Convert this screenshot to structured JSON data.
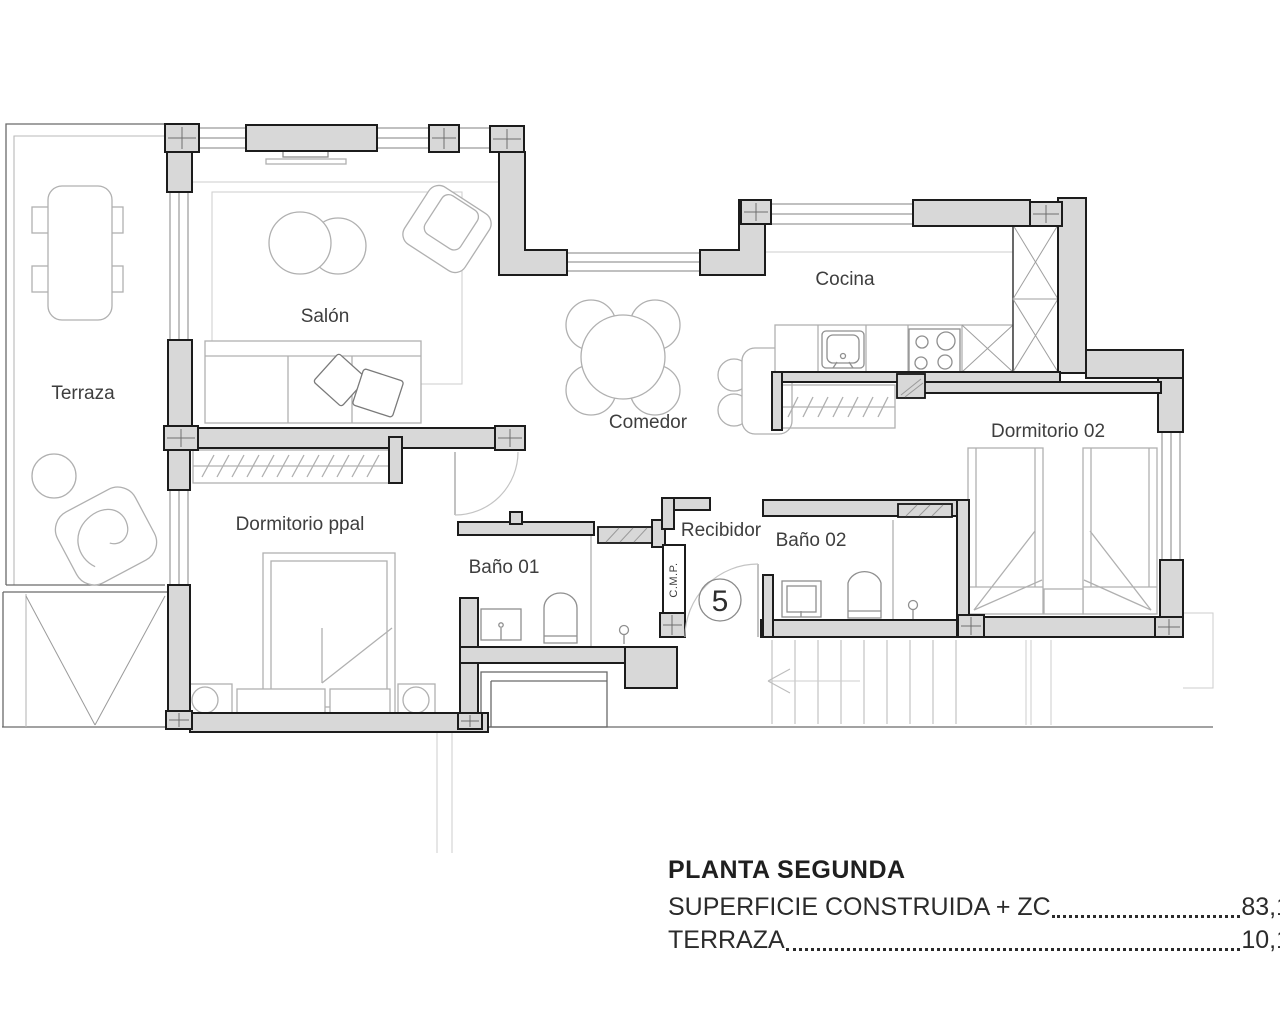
{
  "plan": {
    "rooms": {
      "terraza": "Terraza",
      "salon": "Salón",
      "cocina": "Cocina",
      "comedor": "Comedor",
      "dormitorio_ppal": "Dormitorio ppal",
      "dormitorio_02": "Dormitorio 02",
      "bano_01": "Baño 01",
      "bano_02": "Baño 02",
      "recibidor": "Recibidor"
    },
    "unit_number": "5",
    "shaft_label": "C.M.P."
  },
  "legend": {
    "title": "PLANTA SEGUNDA",
    "rows": [
      {
        "label": "SUPERFICIE CONSTRUIDA + ZC",
        "value": "83,1"
      },
      {
        "label": "TERRAZA",
        "value": "10,1"
      }
    ]
  },
  "colors": {
    "wall_fill": "#d8d8d8",
    "wall_stroke": "#1c1c1c",
    "furniture": "#b0b0b0",
    "text": "#3e3e3e"
  }
}
